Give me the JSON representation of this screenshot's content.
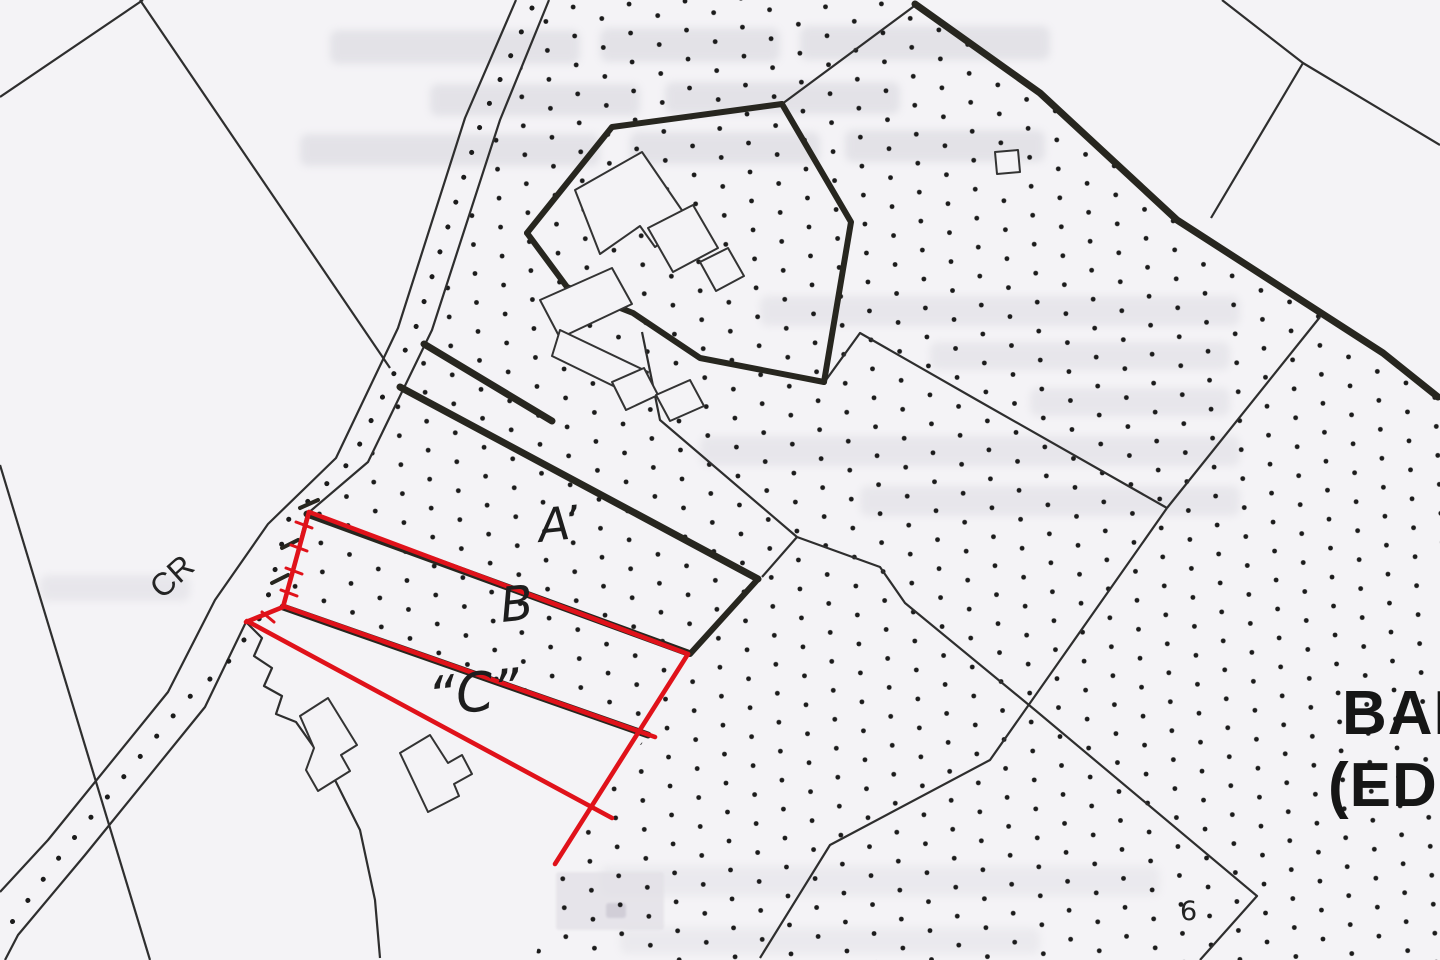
{
  "map": {
    "kind": "scanned-site-location-map",
    "labels": {
      "road": "CR",
      "plot_a": "A’",
      "plot_b": "B",
      "plot_c": "“C”",
      "parcel_number": "6",
      "townland_line1": "BAL",
      "townland_line2": "(ED"
    },
    "colors": {
      "paper": "#f4f3f6",
      "ink_thin": "#2e2e2e",
      "ink_pencil": "#27261f",
      "outline_red": "#e0121a",
      "stipple_dot": "#1b1b1b"
    },
    "features": {
      "red_outlined_plots": [
        "B",
        "C"
      ],
      "black_outlined_plot": "A",
      "road_code": "CR",
      "stippled_fields": true,
      "building_cluster": "farmyard at top centre, two L-shaped buildings lower left, small square building top right",
      "watermarks": {
        "legible": false,
        "top_rows": 3,
        "right_rows": 5,
        "bottom_rows": 1
      }
    }
  }
}
